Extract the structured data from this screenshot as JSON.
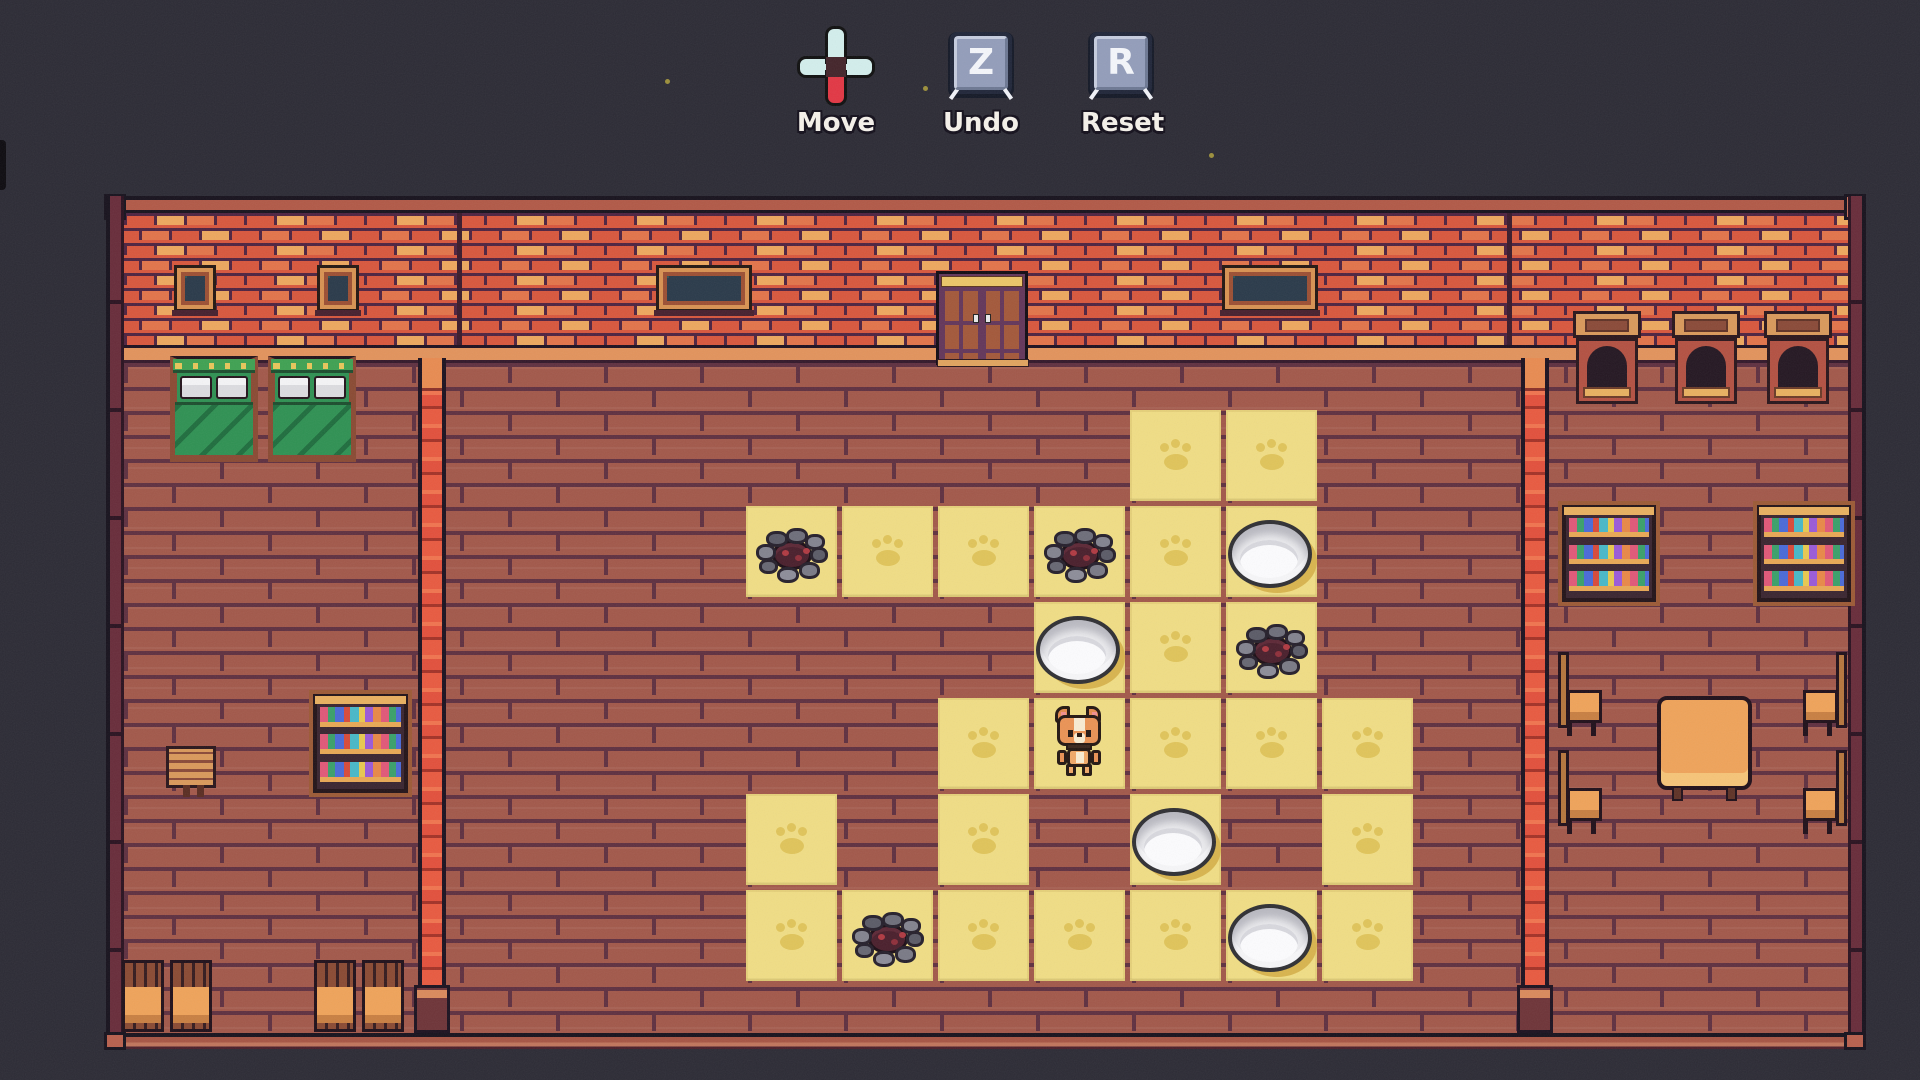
{
  "hud": {
    "controls": [
      {
        "id": "move",
        "label": "Move",
        "icon": "dpad-icon"
      },
      {
        "id": "undo",
        "label": "Undo",
        "key": "Z",
        "icon": "keycap-icon"
      },
      {
        "id": "reset",
        "label": "Reset",
        "key": "R",
        "icon": "keycap-icon"
      }
    ]
  },
  "board": {
    "rows": 6,
    "cols": 7,
    "origin": {
      "x": 746,
      "y": 410
    },
    "pitch": 96,
    "tile_size": 91,
    "player": {
      "row": 3,
      "col": 3,
      "sprite": "corgi-dog"
    },
    "counts": {
      "bowls": 4,
      "targets": 4,
      "tiles": 27
    },
    "cells": [
      {
        "r": 0,
        "c": 4,
        "t": "paw"
      },
      {
        "r": 0,
        "c": 5,
        "t": "paw"
      },
      {
        "r": 1,
        "c": 0,
        "t": "target"
      },
      {
        "r": 1,
        "c": 1,
        "t": "paw"
      },
      {
        "r": 1,
        "c": 2,
        "t": "paw"
      },
      {
        "r": 1,
        "c": 3,
        "t": "target"
      },
      {
        "r": 1,
        "c": 4,
        "t": "paw"
      },
      {
        "r": 1,
        "c": 5,
        "t": "bowl"
      },
      {
        "r": 2,
        "c": 3,
        "t": "bowl"
      },
      {
        "r": 2,
        "c": 4,
        "t": "paw"
      },
      {
        "r": 2,
        "c": 5,
        "t": "target"
      },
      {
        "r": 3,
        "c": 2,
        "t": "paw"
      },
      {
        "r": 3,
        "c": 3,
        "t": "player"
      },
      {
        "r": 3,
        "c": 4,
        "t": "paw"
      },
      {
        "r": 3,
        "c": 5,
        "t": "paw"
      },
      {
        "r": 3,
        "c": 6,
        "t": "paw"
      },
      {
        "r": 4,
        "c": 0,
        "t": "paw"
      },
      {
        "r": 4,
        "c": 2,
        "t": "paw"
      },
      {
        "r": 4,
        "c": 4,
        "t": "bowl"
      },
      {
        "r": 4,
        "c": 6,
        "t": "paw"
      },
      {
        "r": 5,
        "c": 0,
        "t": "paw"
      },
      {
        "r": 5,
        "c": 1,
        "t": "target"
      },
      {
        "r": 5,
        "c": 2,
        "t": "paw"
      },
      {
        "r": 5,
        "c": 3,
        "t": "paw"
      },
      {
        "r": 5,
        "c": 4,
        "t": "paw"
      },
      {
        "r": 5,
        "c": 5,
        "t": "bowl"
      },
      {
        "r": 5,
        "c": 6,
        "t": "paw"
      }
    ],
    "sprites": {
      "player": "corgi-dog",
      "bowl": "white-food-bowl",
      "target": "stone-food-pit",
      "paw": "paw-print-marker"
    }
  },
  "palette": {
    "background": "#2c2b35",
    "wall_brick": "#d8573d",
    "wall_brick_highlight": "#eda75e",
    "floor_brick": "#a2584a",
    "tile_yellow": "#f0dd85",
    "paw_gold": "#dec053",
    "dpad_pale": "#d3eeec",
    "dpad_red": "#e23744",
    "keycap_gray": "#939dba"
  }
}
